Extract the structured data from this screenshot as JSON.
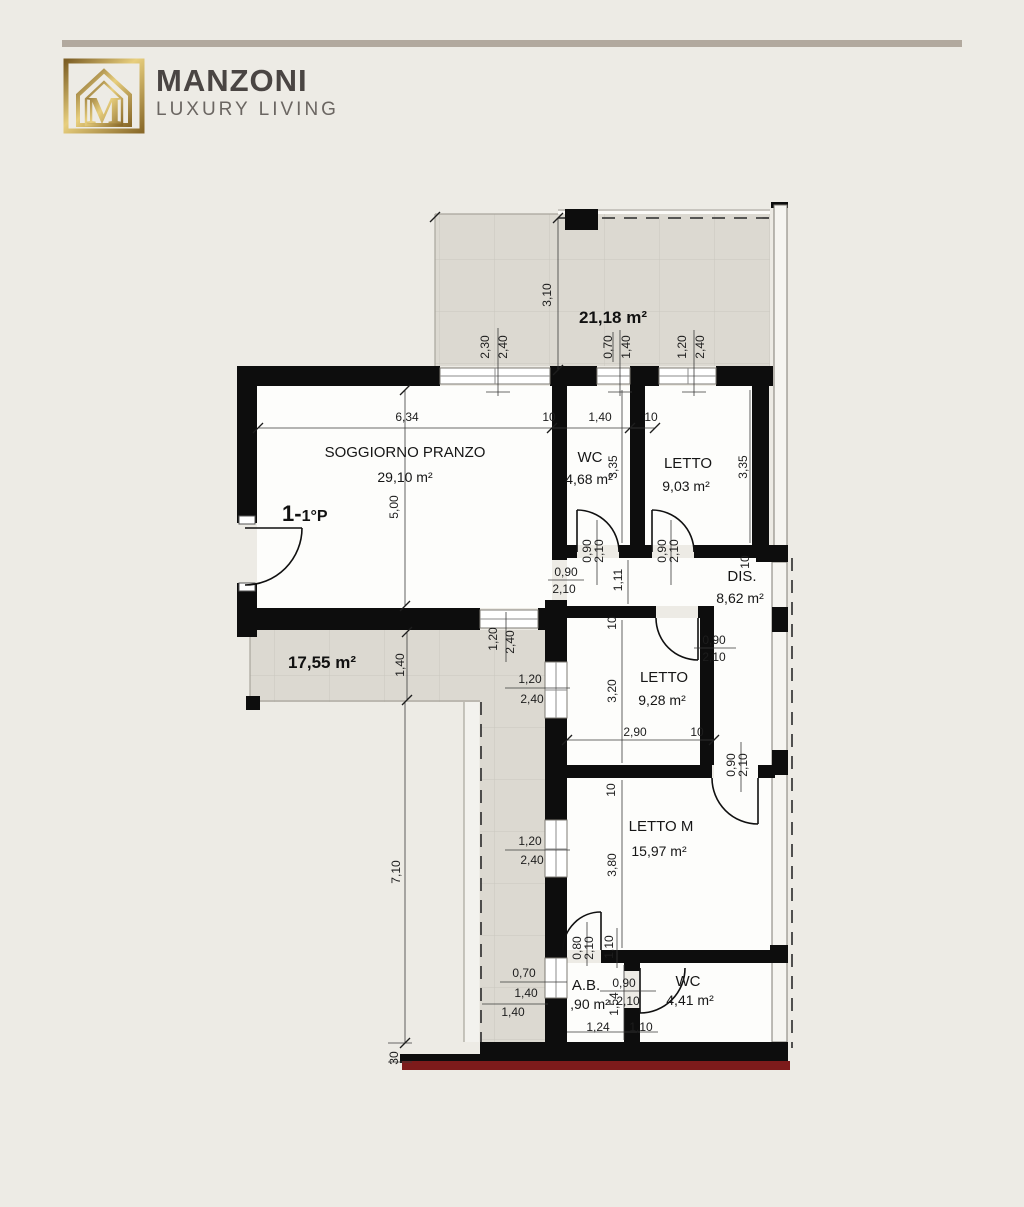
{
  "brand": {
    "name": "MANZONI",
    "tagline": "LUXURY LIVING",
    "monogram": "M"
  },
  "colors": {
    "background": "#edebe5",
    "header_bar": "#b2a99e",
    "logo_gold": "#a9842e",
    "brand_text": "#4a4543",
    "tagline_text": "#6b6662",
    "wall": "#0d0d0d",
    "terrace_tile": "#dcd9d1",
    "accent_red_line": "#7d1b1b"
  },
  "plan": {
    "unit": {
      "part1": "1-",
      "part2": "1°P"
    },
    "rooms": {
      "soggiorno": {
        "name": "SOGGIORNO PRANZO",
        "area": "29,10 m²"
      },
      "wc1": {
        "name": "WC",
        "area": "4,68 m²"
      },
      "letto1": {
        "name": "LETTO",
        "area": "9,03 m²"
      },
      "dis": {
        "name": "DIS.",
        "area": "8,62 m²"
      },
      "letto2": {
        "name": "LETTO",
        "area": "9,28 m²"
      },
      "lettom": {
        "name": "LETTO M",
        "area": "15,97 m²"
      },
      "ab": {
        "name": "A.B.",
        "area": ",90 m²"
      },
      "wc2": {
        "name": "WC",
        "area": "4,41 m²"
      }
    },
    "terraces": {
      "top": {
        "area": "21,18 m²"
      },
      "left": {
        "area": "17,55 m²"
      }
    },
    "dims": [
      {
        "t": "3,10"
      },
      {
        "t": "2,30"
      },
      {
        "t": "2,40"
      },
      {
        "t": "0,70"
      },
      {
        "t": "1,40"
      },
      {
        "t": "1,20"
      },
      {
        "t": "2,40"
      },
      {
        "t": "6,34"
      },
      {
        "t": "10"
      },
      {
        "t": "1,40"
      },
      {
        "t": "10"
      },
      {
        "t": "3,35"
      },
      {
        "t": "3,35"
      },
      {
        "t": "5,00"
      },
      {
        "t": "0,90"
      },
      {
        "t": "2,10"
      },
      {
        "t": "0,90"
      },
      {
        "t": "2,10"
      },
      {
        "t": "10"
      },
      {
        "t": "0,90"
      },
      {
        "t": "2,10"
      },
      {
        "t": "1,11"
      },
      {
        "t": "10"
      },
      {
        "t": "1,20"
      },
      {
        "t": "2,40"
      },
      {
        "t": "0,90"
      },
      {
        "t": "2,10"
      },
      {
        "t": "1,20"
      },
      {
        "t": "2,40"
      },
      {
        "t": "1,40"
      },
      {
        "t": "3,20"
      },
      {
        "t": "2,90"
      },
      {
        "t": "10"
      },
      {
        "t": "10"
      },
      {
        "t": "0,90"
      },
      {
        "t": "2,10"
      },
      {
        "t": "3,80"
      },
      {
        "t": "1,20"
      },
      {
        "t": "2,40"
      },
      {
        "t": "7,10"
      },
      {
        "t": "0,80"
      },
      {
        "t": "2,10"
      },
      {
        "t": "1,10"
      },
      {
        "t": "0,70"
      },
      {
        "t": "1,40"
      },
      {
        "t": "1,40"
      },
      {
        "t": "0,90"
      },
      {
        "t": "2,10"
      },
      {
        "t": "1,54"
      },
      {
        "t": "1,24"
      },
      {
        "t": "1,10"
      },
      {
        "t": "30"
      }
    ]
  }
}
